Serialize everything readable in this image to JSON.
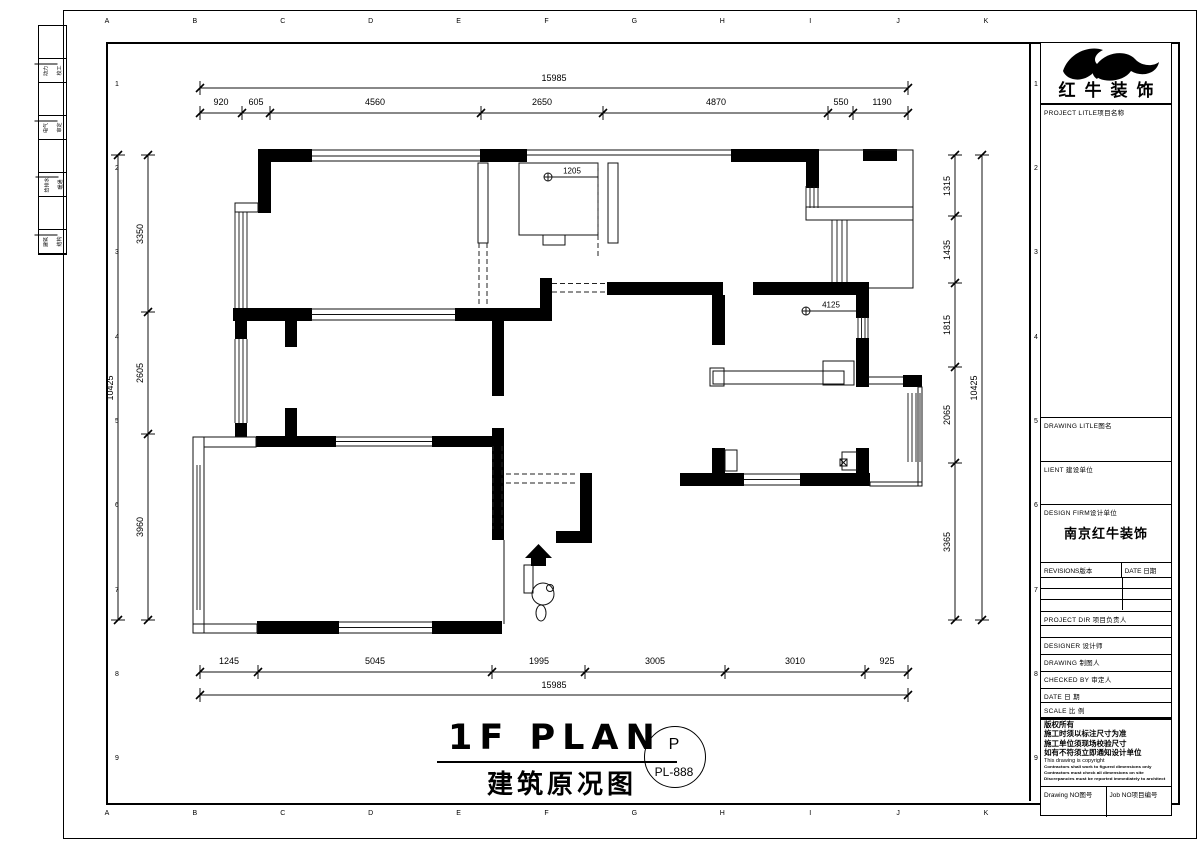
{
  "sheet": {
    "grid_letters": [
      "A",
      "B",
      "C",
      "D",
      "E",
      "F",
      "G",
      "H",
      "I",
      "J",
      "K"
    ],
    "grid_numbers": [
      "1",
      "2",
      "3",
      "4",
      "5",
      "6",
      "7",
      "8",
      "9"
    ],
    "side_strip_rows": [
      [
        "动力",
        "校工"
      ],
      [
        "电气",
        "审定"
      ],
      [
        "给排水",
        "暖通"
      ],
      [
        "建筑",
        "结构"
      ]
    ]
  },
  "dimensions": {
    "top": {
      "overall": "15985",
      "segments": [
        "920",
        "605",
        "4560",
        "2650",
        "4870",
        "550",
        "1190"
      ]
    },
    "bottom": {
      "overall": "15985",
      "segments": [
        "1245",
        "5045",
        "1995",
        "3005",
        "3010",
        "925"
      ]
    },
    "left": {
      "overall": "10425",
      "segments": [
        "3350",
        "2605",
        "3960"
      ]
    },
    "right": {
      "overall": "10425",
      "segments": [
        "1315",
        "1435",
        "1815",
        "2065",
        "3365"
      ]
    }
  },
  "plan_annotations": {
    "closet_dim": "1205",
    "wall_dim": "4125"
  },
  "title": {
    "main": "1F PLAN",
    "subtitle": "建筑原况图",
    "stamp_letter": "P",
    "drawing_no": "PL-888"
  },
  "title_block": {
    "logo_text": "红牛装饰",
    "project_label": "PROJECT LITLE项目名称",
    "drawing_title_label": "DRAWING LITLE图名",
    "client_label": "LIENT 建设单位",
    "design_firm_label": "DESIGN FIRM设计单位",
    "design_firm_value": "南京红牛装饰",
    "revisions_label": "REVISIONS版本",
    "date_col_label": "DATE 日期",
    "project_dir_label": "PROJECT DIR 项目负责人",
    "designer_label": "DESIGNER 设计师",
    "drawing_label": "DRAWING 制图人",
    "checked_label": "CHECKED BY 审定人",
    "date_label": "DATE 日 期",
    "scale_label": "SCALE 比 例",
    "copyright_lines": [
      "版权所有",
      "施工时须以标注尺寸为准",
      "施工单位须现场校验尺寸",
      "如有不符须立即通知设计单位",
      "This drawing is copyright",
      "Contractors shall work to figured dimensions only",
      "Contractors must check all dimensions on site",
      "Discrepancies must be reported immediately to architect"
    ],
    "drawing_no_label": "Drawing NO图号",
    "job_no_label": "Job NO项目编号"
  }
}
